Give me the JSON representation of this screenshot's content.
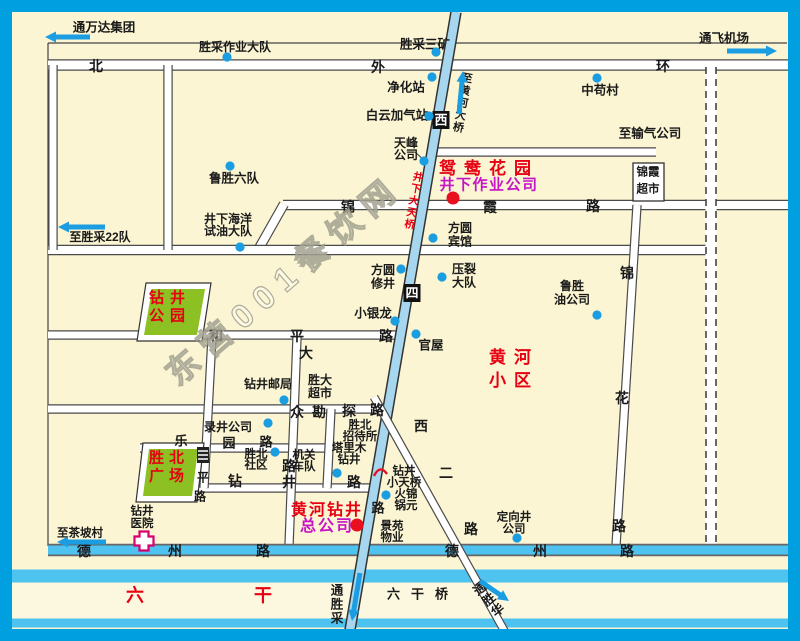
{
  "watermark": {
    "text": "东营001餐饮网"
  },
  "colors": {
    "frame": "#00A0E0",
    "bg": "#FBF5D3",
    "road_fill": "#FFFFFF",
    "road_edge": "#4A4A4A",
    "cyan_road": "#4FC3F0",
    "blue_road": "#A6D7EF",
    "canal_strip": "#FCF8DF",
    "blue_dot": "#1B9DE2",
    "red_dot": "#E8101E",
    "red_text": "#E60012",
    "magenta_text": "#C515C5",
    "green_area": "#8CC023",
    "arrow": "#1B9DE2",
    "hospital_pink": "#D6006E",
    "badge_bg": "#111111"
  },
  "roads": {
    "white": [
      {
        "name": "north-outer-ring-road",
        "x1": 48,
        "y1": 65,
        "x2": 788,
        "y2": 65,
        "w": 9
      },
      {
        "name": "gas-company-road",
        "x1": 437,
        "y1": 152,
        "x2": 656,
        "y2": 152,
        "w": 7
      },
      {
        "name": "jinxia-road",
        "x1": 283,
        "y1": 205,
        "x2": 788,
        "y2": 205,
        "w": 8
      },
      {
        "name": "jinxia-road-connector",
        "x1": 284,
        "y1": 204,
        "x2": 258,
        "y2": 250,
        "w": 8
      },
      {
        "name": "middle-cross-road",
        "x1": 48,
        "y1": 250,
        "x2": 712,
        "y2": 250,
        "w": 8
      },
      {
        "name": "heping-road",
        "x1": 48,
        "y1": 335,
        "x2": 404,
        "y2": 335,
        "w": 7
      },
      {
        "name": "kantan-road",
        "x1": 48,
        "y1": 409,
        "x2": 378,
        "y2": 409,
        "w": 7
      },
      {
        "name": "leyuan-road",
        "x1": 140,
        "y1": 448,
        "x2": 333,
        "y2": 448,
        "w": 7
      },
      {
        "name": "zuanjing-road",
        "x1": 196,
        "y1": 488,
        "x2": 373,
        "y2": 488,
        "w": 7
      },
      {
        "name": "west-edge-road",
        "x1": 53,
        "y1": 65,
        "x2": 53,
        "y2": 250,
        "w": 7
      },
      {
        "name": "left-vertical-road",
        "x1": 168,
        "y1": 65,
        "x2": 168,
        "y2": 250,
        "w": 7
      },
      {
        "name": "pingan-side-road",
        "x1": 212,
        "y1": 337,
        "x2": 204,
        "y2": 488,
        "w": 7
      },
      {
        "name": "dazhong-road",
        "x1": 297,
        "y1": 337,
        "x2": 289,
        "y2": 546,
        "w": 7
      },
      {
        "name": "short-vertical-road",
        "x1": 331,
        "y1": 409,
        "x2": 327,
        "y2": 488,
        "w": 7
      },
      {
        "name": "jinhua-road",
        "x1": 637,
        "y1": 205,
        "x2": 616,
        "y2": 546,
        "w": 7
      }
    ],
    "dashed": [
      {
        "name": "dashed-planned-road",
        "x1": 711,
        "y1": 67,
        "x2": 711,
        "y2": 546,
        "w": 11
      }
    ],
    "cyan": [
      {
        "name": "dezhou-road",
        "x1": 48,
        "y1": 550,
        "x2": 788,
        "y2": 550,
        "w": 9
      }
    ],
    "canal": {
      "name": "liugan-canal",
      "strip": {
        "x": 12,
        "y": 583,
        "w": 776,
        "h": 36
      },
      "top": {
        "x1": 12,
        "y1": 576,
        "x2": 788,
        "y2": 576,
        "w": 13
      },
      "bottom": {
        "x1": 12,
        "y1": 623,
        "x2": 788,
        "y2": 623,
        "w": 9
      }
    },
    "blue_diag": [
      {
        "name": "xisi-road",
        "x1": 456,
        "y1": 12,
        "x2": 350,
        "y2": 630,
        "w": 8.5
      }
    ],
    "white_diag": [
      {
        "name": "xier-road",
        "x1": 374,
        "y1": 397,
        "x2": 505,
        "y2": 632,
        "w": 6.5
      }
    ]
  },
  "road_chars": [
    {
      "t": "北",
      "x": 96,
      "y": 66,
      "s": 14
    },
    {
      "t": "外",
      "x": 378,
      "y": 67,
      "s": 14
    },
    {
      "t": "环",
      "x": 663,
      "y": 66,
      "s": 14
    },
    {
      "t": "锦",
      "x": 348,
      "y": 207,
      "s": 14
    },
    {
      "t": "霞",
      "x": 490,
      "y": 207,
      "s": 14
    },
    {
      "t": "路",
      "x": 593,
      "y": 206,
      "s": 14
    },
    {
      "t": "和",
      "x": 216,
      "y": 336,
      "s": 14
    },
    {
      "t": "平",
      "x": 297,
      "y": 336,
      "s": 14
    },
    {
      "t": "路",
      "x": 386,
      "y": 336,
      "s": 14
    },
    {
      "t": "大",
      "x": 306,
      "y": 353,
      "s": 14
    },
    {
      "t": "众",
      "x": 297,
      "y": 412,
      "s": 14
    },
    {
      "t": "路",
      "x": 289,
      "y": 466,
      "s": 14
    },
    {
      "t": "勘",
      "x": 319,
      "y": 412,
      "s": 14
    },
    {
      "t": "探",
      "x": 349,
      "y": 411,
      "s": 14
    },
    {
      "t": "路",
      "x": 377,
      "y": 410,
      "s": 14
    },
    {
      "t": "乐",
      "x": 181,
      "y": 441,
      "s": 13
    },
    {
      "t": "园",
      "x": 229,
      "y": 443,
      "s": 13
    },
    {
      "t": "路",
      "x": 266,
      "y": 442,
      "s": 13
    },
    {
      "t": "钻",
      "x": 235,
      "y": 481,
      "s": 14
    },
    {
      "t": "井",
      "x": 289,
      "y": 482,
      "s": 14
    },
    {
      "t": "路",
      "x": 354,
      "y": 482,
      "s": 14
    },
    {
      "t": "平",
      "x": 203,
      "y": 477,
      "s": 12
    },
    {
      "t": "路",
      "x": 200,
      "y": 496,
      "s": 12
    },
    {
      "t": "锦",
      "x": 627,
      "y": 273,
      "s": 14
    },
    {
      "t": "花",
      "x": 622,
      "y": 398,
      "s": 14
    },
    {
      "t": "路",
      "x": 619,
      "y": 526,
      "s": 14
    },
    {
      "t": "西",
      "x": 421,
      "y": 426,
      "s": 14
    },
    {
      "t": "二",
      "x": 446,
      "y": 473,
      "s": 14
    },
    {
      "t": "路",
      "x": 471,
      "y": 529,
      "s": 14
    },
    {
      "t": "路",
      "x": 378,
      "y": 508,
      "s": 13
    },
    {
      "t": "德",
      "x": 84,
      "y": 551,
      "s": 14
    },
    {
      "t": "州",
      "x": 175,
      "y": 551,
      "s": 14
    },
    {
      "t": "路",
      "x": 263,
      "y": 551,
      "s": 14
    },
    {
      "t": "德",
      "x": 452,
      "y": 551,
      "s": 14
    },
    {
      "t": "州",
      "x": 540,
      "y": 551,
      "s": 14
    },
    {
      "t": "路",
      "x": 627,
      "y": 551,
      "s": 14
    },
    {
      "t": "六",
      "x": 135,
      "y": 595,
      "s": 18,
      "c": "#E60012"
    },
    {
      "t": "干",
      "x": 263,
      "y": 595,
      "s": 18,
      "c": "#E60012"
    }
  ],
  "badges": [
    {
      "name": "xisi-road-badge-xi",
      "t": "西",
      "x": 441,
      "y": 120
    },
    {
      "name": "xisi-road-badge-si",
      "t": "四",
      "x": 412,
      "y": 293
    }
  ],
  "labels": [
    {
      "name": "tong-wanda-group",
      "lines": [
        "通万达集团"
      ],
      "x": 104,
      "y": 21,
      "s": 12.5
    },
    {
      "name": "shengcai-work-brigade",
      "lines": [
        "胜采作业大队"
      ],
      "x": 235,
      "y": 41,
      "s": 12
    },
    {
      "name": "shengcai-no3-mine",
      "lines": [
        "胜采三矿"
      ],
      "x": 425,
      "y": 38,
      "s": 12.5
    },
    {
      "name": "purification-station",
      "lines": [
        "净化站"
      ],
      "x": 406,
      "y": 81,
      "s": 12.5
    },
    {
      "name": "zhonggou-village",
      "lines": [
        "中苟村"
      ],
      "x": 600,
      "y": 84,
      "s": 12.5
    },
    {
      "name": "tong-airport",
      "lines": [
        "通飞机场"
      ],
      "x": 724,
      "y": 32,
      "s": 12.5
    },
    {
      "name": "baiyun-gas-station",
      "lines": [
        "白云加气站"
      ],
      "x": 397,
      "y": 109,
      "s": 12.5
    },
    {
      "name": "to-gas-company",
      "lines": [
        "至输气公司"
      ],
      "x": 650,
      "y": 127,
      "s": 12.5
    },
    {
      "name": "tianfeng-company",
      "lines": [
        "天峰",
        "公司"
      ],
      "x": 406,
      "y": 137,
      "s": 12,
      "lh": 12
    },
    {
      "name": "lusheng-no6-team",
      "lines": [
        "鲁胜六队"
      ],
      "x": 234,
      "y": 172,
      "s": 12.5
    },
    {
      "name": "jingxia-ocean-test-brigade",
      "lines": [
        "井下海洋",
        "试油大队"
      ],
      "x": 228,
      "y": 213,
      "s": 12,
      "lh": 12
    },
    {
      "name": "to-shengcai-22",
      "lines": [
        "至胜采22队"
      ],
      "x": 100,
      "y": 231,
      "s": 12
    },
    {
      "name": "jinxia-supermarket",
      "lines": [
        "锦霞",
        "超市"
      ],
      "x": 648,
      "y": 166,
      "s": 11.5,
      "lh": 17
    },
    {
      "name": "fangyuan-hotel",
      "lines": [
        "方圆",
        "宾馆"
      ],
      "x": 460,
      "y": 222,
      "s": 12,
      "lh": 13.5
    },
    {
      "name": "fangyuan-workover",
      "lines": [
        "方圆",
        "修井"
      ],
      "x": 383,
      "y": 264,
      "s": 12,
      "lh": 13.5
    },
    {
      "name": "yalie-brigade",
      "lines": [
        "压裂",
        "大队"
      ],
      "x": 464,
      "y": 263,
      "s": 12,
      "lh": 13.5
    },
    {
      "name": "lusheng-oil-company",
      "lines": [
        "鲁胜",
        "油公司"
      ],
      "x": 572,
      "y": 280,
      "s": 12,
      "lh": 13.5
    },
    {
      "name": "xiaoyinlong",
      "lines": [
        "小银龙"
      ],
      "x": 373,
      "y": 307,
      "s": 12.5
    },
    {
      "name": "guanwu",
      "lines": [
        "官屋"
      ],
      "x": 431,
      "y": 339,
      "s": 12.5
    },
    {
      "name": "zuanjing-post-office",
      "lines": [
        "钻井邮局"
      ],
      "x": 268,
      "y": 378,
      "s": 12
    },
    {
      "name": "shengda-supermarket",
      "lines": [
        "胜大",
        "超市"
      ],
      "x": 320,
      "y": 374,
      "s": 12,
      "lh": 13
    },
    {
      "name": "shengbei-guesthouse",
      "lines": [
        "胜北",
        "招待所"
      ],
      "x": 360,
      "y": 419,
      "s": 11.5,
      "lh": 11.5
    },
    {
      "name": "lujing-company",
      "lines": [
        "录井公司"
      ],
      "x": 228,
      "y": 421,
      "s": 12
    },
    {
      "name": "talimu-drilling",
      "lines": [
        "塔里木",
        "钻井"
      ],
      "x": 349,
      "y": 442,
      "s": 11.5,
      "lh": 11.5
    },
    {
      "name": "jiguan-motorcade",
      "lines": [
        "机关",
        "车队"
      ],
      "x": 304,
      "y": 449,
      "s": 11.5,
      "lh": 11.5
    },
    {
      "name": "shengbei-community",
      "lines": [
        "胜北",
        "社区"
      ],
      "x": 256,
      "y": 448,
      "s": 11.5,
      "lh": 11
    },
    {
      "name": "zuanjing-small-footbridge",
      "lines": [
        "钻井",
        "小天桥"
      ],
      "x": 404,
      "y": 465,
      "s": 11.5,
      "lh": 11.5
    },
    {
      "name": "jinyuan-hotpot",
      "lines": [
        "火锦",
        "锅元"
      ],
      "x": 406,
      "y": 488,
      "s": 11.5,
      "lh": 11.5
    },
    {
      "name": "jingyuan-property",
      "lines": [
        "景苑",
        "物业"
      ],
      "x": 392,
      "y": 520,
      "s": 11.5,
      "lh": 11.5
    },
    {
      "name": "zuanjing-hospital",
      "lines": [
        "钻井",
        "医院"
      ],
      "x": 142,
      "y": 505,
      "s": 11.5,
      "lh": 12.5
    },
    {
      "name": "to-chapo-village",
      "lines": [
        "至茶坡村"
      ],
      "x": 80,
      "y": 527,
      "s": 11.5
    },
    {
      "name": "dingxiangjing-company",
      "lines": [
        "定向井",
        "公司"
      ],
      "x": 514,
      "y": 511,
      "s": 11.5,
      "lh": 12
    },
    {
      "name": "liugan-bridge",
      "lines": [
        "六干桥"
      ],
      "x": 423,
      "y": 588,
      "s": 13,
      "ls": 11
    },
    {
      "name": "yuanyang-garden",
      "lines": [
        "鸳鸯花园"
      ],
      "x": 489,
      "y": 160,
      "s": 17,
      "ls": 8,
      "c": "#E60012"
    },
    {
      "name": "jingxia-operation-company",
      "lines": [
        "井下作业公司"
      ],
      "x": 489,
      "y": 177,
      "s": 15,
      "ls": 1.5,
      "c": "#C515C5"
    },
    {
      "name": "huanghe-residential",
      "lines": [
        "黄河",
        "小区"
      ],
      "x": 514,
      "y": 349,
      "s": 17,
      "ls": 8,
      "lh": 23,
      "c": "#E60012"
    },
    {
      "name": "huanghe-drilling-hq-1",
      "lines": [
        "黄河钻井"
      ],
      "x": 327,
      "y": 502,
      "s": 16,
      "ls": 2,
      "c": "#E60012"
    },
    {
      "name": "huanghe-drilling-hq-2",
      "lines": [
        "总公司"
      ],
      "x": 327,
      "y": 518,
      "s": 16,
      "ls": 2,
      "c": "#C515C5"
    },
    {
      "name": "zuanjing-park",
      "lines": [
        "钻井",
        "公园"
      ],
      "x": 170,
      "y": 290,
      "s": 15,
      "ls": 6,
      "lh": 18,
      "c": "#E60012"
    },
    {
      "name": "shengbei-square",
      "lines": [
        "胜北",
        "广场"
      ],
      "x": 169,
      "y": 450,
      "s": 15,
      "ls": 5,
      "lh": 18,
      "c": "#E60012"
    }
  ],
  "rot_labels": [
    {
      "name": "to-huanghe-bridge",
      "text": "至黄河大桥",
      "x": 468,
      "y": 73,
      "rot": 10,
      "s": 11,
      "c": "#1a1a1a"
    },
    {
      "name": "jingxia-big-footbridge",
      "text": "井下大天桥",
      "x": 419,
      "y": 172,
      "rot": 10,
      "s": 10.5,
      "c": "#E60012"
    },
    {
      "name": "tong-shengcai",
      "text": "通胜采",
      "x": 337,
      "y": 584,
      "rot": 0,
      "s": 12.5,
      "c": "#1a1a1a"
    },
    {
      "name": "tong-shenghua",
      "text": "通胜华",
      "x": 476,
      "y": 584,
      "rot": -40,
      "s": 12.5,
      "c": "#1a1a1a"
    }
  ],
  "dots": {
    "blue": [
      {
        "name": "dot-shengcai-work-brigade",
        "x": 227,
        "y": 57
      },
      {
        "name": "dot-shengcai-no3-mine",
        "x": 436,
        "y": 52
      },
      {
        "name": "dot-purification-station",
        "x": 432,
        "y": 77
      },
      {
        "name": "dot-zhonggou-village",
        "x": 597,
        "y": 78
      },
      {
        "name": "dot-baiyun-gas",
        "x": 429,
        "y": 116
      },
      {
        "name": "dot-tianfeng",
        "x": 424,
        "y": 161
      },
      {
        "name": "dot-lusheng-no6",
        "x": 230,
        "y": 166
      },
      {
        "name": "dot-jingxia-ocean",
        "x": 240,
        "y": 247
      },
      {
        "name": "dot-fangyuan-hotel",
        "x": 433,
        "y": 238
      },
      {
        "name": "dot-fangyuan-workover",
        "x": 401,
        "y": 269
      },
      {
        "name": "dot-yalie",
        "x": 442,
        "y": 277
      },
      {
        "name": "dot-lusheng-oil",
        "x": 597,
        "y": 315
      },
      {
        "name": "dot-xiaoyinlong",
        "x": 395,
        "y": 321
      },
      {
        "name": "dot-guanwu",
        "x": 416,
        "y": 334
      },
      {
        "name": "dot-post-office",
        "x": 284,
        "y": 400
      },
      {
        "name": "dot-lujing",
        "x": 268,
        "y": 423
      },
      {
        "name": "dot-shengbei-community",
        "x": 275,
        "y": 452
      },
      {
        "name": "dot-talimu",
        "x": 337,
        "y": 473
      },
      {
        "name": "dot-hotpot",
        "x": 386,
        "y": 495
      },
      {
        "name": "dot-dingxiangjing",
        "x": 517,
        "y": 538
      }
    ],
    "red": [
      {
        "name": "dot-jingxia-operation",
        "x": 453,
        "y": 198
      },
      {
        "name": "dot-huanghe-drilling-hq",
        "x": 357,
        "y": 525
      }
    ]
  },
  "arrows": [
    {
      "name": "arrow-wanda-left",
      "x1": 90,
      "y1": 37,
      "x2": 45,
      "y2": 37
    },
    {
      "name": "arrow-shengcai22-left",
      "x1": 105,
      "y1": 227,
      "x2": 58,
      "y2": 227
    },
    {
      "name": "arrow-chapo-left",
      "x1": 106,
      "y1": 542,
      "x2": 57,
      "y2": 542
    },
    {
      "name": "arrow-airport-right",
      "x1": 727,
      "y1": 51,
      "x2": 777,
      "y2": 51
    },
    {
      "name": "arrow-huanghe-bridge-up",
      "x1": 459,
      "y1": 114,
      "x2": 463,
      "y2": 71
    },
    {
      "name": "arrow-tongshengcai-down",
      "x1": 360,
      "y1": 573,
      "x2": 352,
      "y2": 621
    },
    {
      "name": "arrow-tongshenghua-downright",
      "x1": 480,
      "y1": 581,
      "x2": 509,
      "y2": 601
    }
  ],
  "areas": [
    {
      "name": "zuanjing-park-area",
      "outer": "146,283 211,283 202,341 137,341",
      "inner": "152,289 205,289 197,335 144,335"
    },
    {
      "name": "shengbei-square-area",
      "outer": "143,443 204,443 197,502 136,502",
      "inner": "149,449 198,449 192,496 143,496"
    }
  ],
  "boxes": [
    {
      "name": "jinxia-supermarket-box",
      "x": 633,
      "y": 163,
      "w": 31,
      "h": 38
    }
  ]
}
